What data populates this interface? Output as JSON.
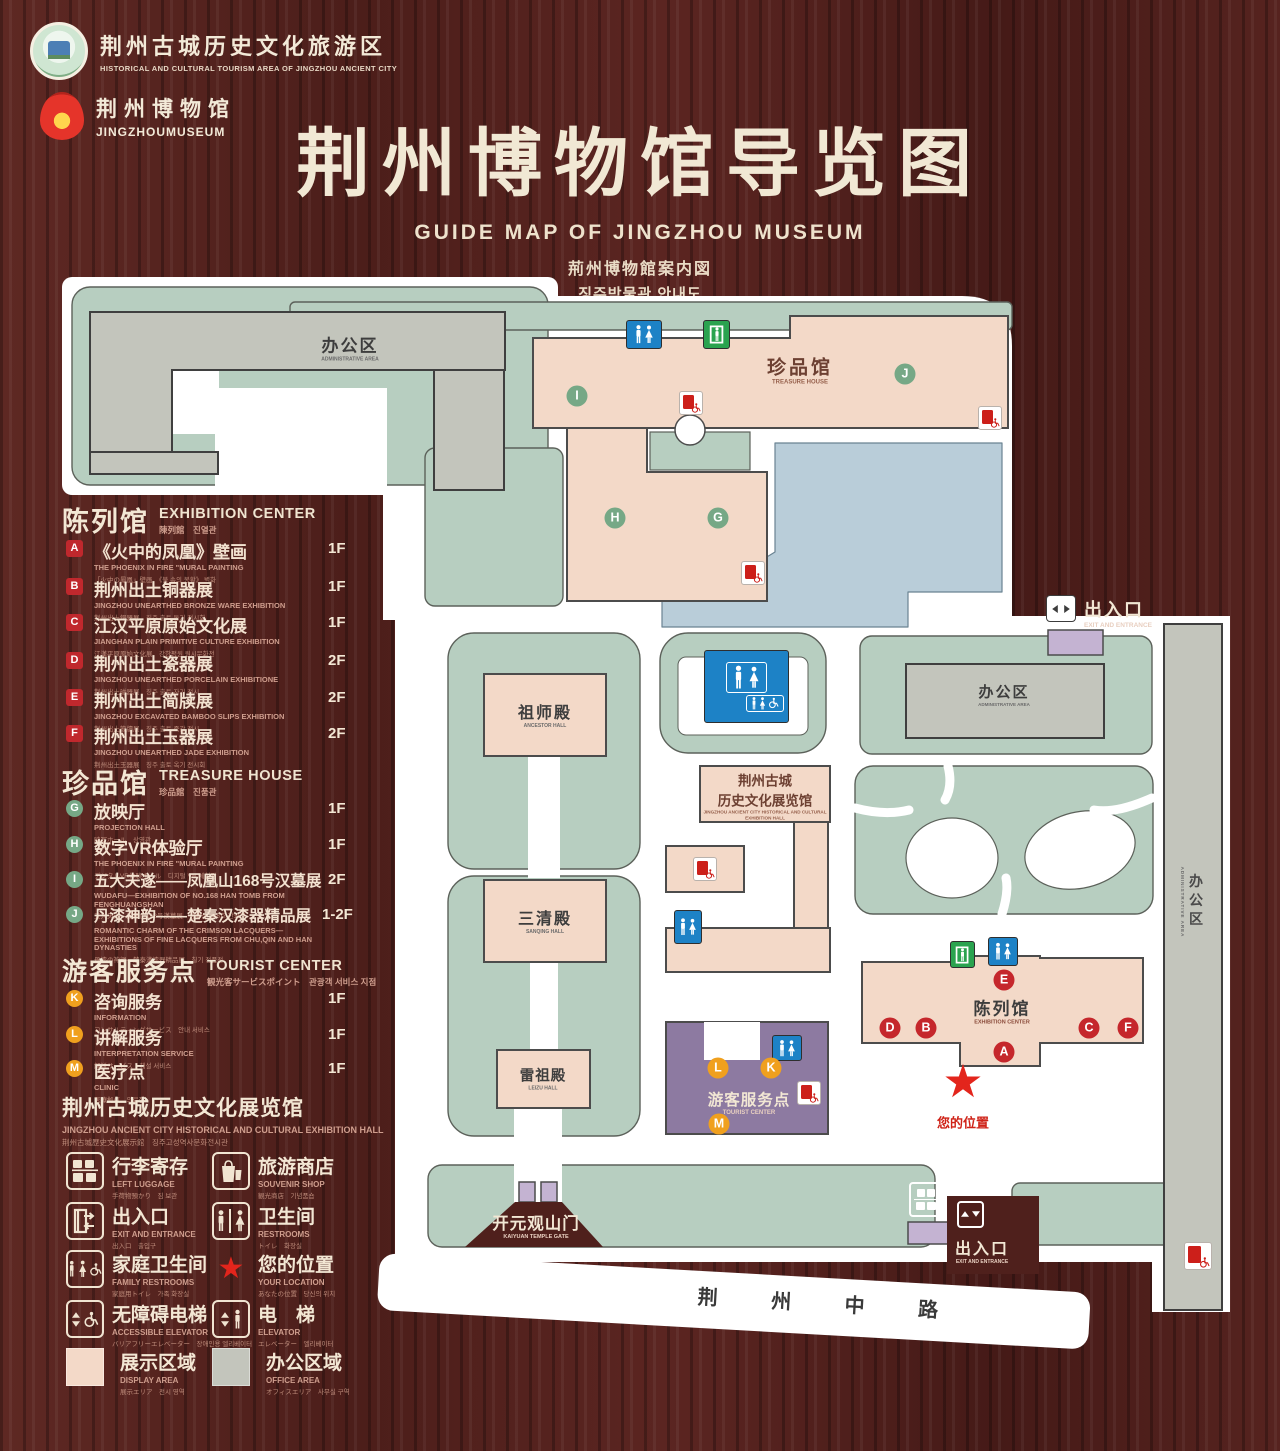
{
  "header": {
    "site_logo": {
      "zh": "荆州古城历史文化旅游区",
      "en": "HISTORICAL AND CULTURAL TOURISM AREA OF JINGZHOU ANCIENT CITY"
    },
    "museum_logo": {
      "zh": "荆州博物馆",
      "en": "JINGZHOUMUSEUM"
    },
    "title_zh": "荆州博物馆导览图",
    "title_en": "GUIDE MAP OF JINGZHOU MUSEUM",
    "title_ja": "荊州博物館案内図",
    "title_ko": "징주박물관 안내도"
  },
  "legend": {
    "sections": [
      {
        "title_zh": "陈列馆",
        "title_en": "EXHIBITION CENTER",
        "subtitle": "陳列館　진열관",
        "items": [
          {
            "letter": "A",
            "zh": "《火中的凤凰》壁画",
            "en": "THE PHOENIX IN FIRE \"MURAL PAINTING",
            "sub": "「火中の鳳凰」壁画　《불 속의 봉황》 벽화",
            "floor": "1F"
          },
          {
            "letter": "B",
            "zh": "荆州出土铜器展",
            "en": "JINGZHOU UNEARTHED BRONZE WARE EXHIBITION",
            "sub": "荆州出土銅器展　징주 출토 동기 전시회",
            "floor": "1F"
          },
          {
            "letter": "C",
            "zh": "江汉平原原始文化展",
            "en": "JIANGHAN PLAIN PRIMITIVE CULTURE EXHIBITION",
            "sub": "江漢平原原始文化展　강한평원 원시문화전",
            "floor": "1F"
          },
          {
            "letter": "D",
            "zh": "荆州出土瓷器展",
            "en": "JINGZHOU UNEARTHED PORCELAIN EXHIBITIONE",
            "sub": "荆州出土磁器展　징주 출토 자기 전시",
            "floor": "2F"
          },
          {
            "letter": "E",
            "zh": "荆州出土简牍展",
            "en": "JINGZHOU EXCAVATED BAMBOO SLIPS EXHIBITION",
            "sub": "荆州出土簡牘展　징주 출토 죽간 전시",
            "floor": "2F"
          },
          {
            "letter": "F",
            "zh": "荆州出土玉器展",
            "en": "JINGZHOU UNEARTHED JADE EXHIBITION",
            "sub": "荆州出土玉器展　징주 출토 옥기 전시회",
            "floor": "2F"
          }
        ]
      },
      {
        "title_zh": "珍品馆",
        "title_en": "TREASURE HOUSE",
        "subtitle": "珍品館　진품관",
        "items": [
          {
            "letter": "G",
            "zh": "放映厅",
            "en": "PROJECTION HALL",
            "sub": "映写ホール　상영관",
            "floor": "1F"
          },
          {
            "letter": "H",
            "zh": "数字VR体验厅",
            "en": "THE PHOENIX IN FIRE \"MURAL PAINTING",
            "sub": "デジタルVR体験ホール　디지털 VR 체험관",
            "floor": "1F"
          },
          {
            "letter": "I",
            "zh": "五大夫遂——凤凰山168号汉墓展",
            "en": "WUDAFU—EXHIBITION OF NO.168 HAN TOMB FROM FENGHUANGSHAN",
            "sub": "五大夫遂—鳳凰山168号漢墓展　봉황산 168호 한묘전",
            "floor": "2F"
          },
          {
            "letter": "J",
            "zh": "丹漆神韵——楚秦汉漆器精品展",
            "en": "ROMANTIC CHARM OF THE CRIMSON LACQUERS— EXHIBITIONS OF FINE LACQUERS FROM CHU,QIN AND HAN DYNASTIES",
            "sub": "丹漆の神韻—楚秦漢漆器精品展　칠기 정품전",
            "floor": "1-2F"
          }
        ]
      },
      {
        "title_zh": "游客服务点",
        "title_en": "TOURIST CENTER",
        "subtitle": "観光客サービスポイント　관광객 서비스 지점",
        "items": [
          {
            "letter": "K",
            "zh": "咨询服务",
            "en": "INFORMATION",
            "sub": "コンサルティングサービス　안내 서비스",
            "floor": "1F"
          },
          {
            "letter": "L",
            "zh": "讲解服务",
            "en": "INTERPRETATION SERVICE",
            "sub": "解説サービス　해설 서비스",
            "floor": "1F"
          },
          {
            "letter": "M",
            "zh": "医疗点",
            "en": "CLINIC",
            "sub": "医療拠点　의료점",
            "floor": "1F"
          }
        ]
      }
    ],
    "hall_note": {
      "zh": "荆州古城历史文化展览馆",
      "en": "JINGZHOU ANCIENT CITY HISTORICAL AND CULTURAL EXHIBITION HALL",
      "sub": "荆州古城歴史文化展示館　징주고성역사문화전시관"
    },
    "facilities": [
      {
        "icon": "left-luggage-icon",
        "zh": "行李寄存",
        "en": "LEFT LUGGAGE",
        "sub": "手荷物預かり　짐 보관"
      },
      {
        "icon": "souvenir-shop-icon",
        "zh": "旅游商店",
        "en": "SOUVENIR SHOP",
        "sub": "観光商店　기념품숍"
      },
      {
        "icon": "exit-entrance-icon",
        "zh": "出入口",
        "en": "EXIT AND ENTRANCE",
        "sub": "出入口　출입구"
      },
      {
        "icon": "restroom-icon",
        "zh": "卫生间",
        "en": "RESTROOMS",
        "sub": "トイレ　화장실"
      },
      {
        "icon": "family-restroom-icon",
        "zh": "家庭卫生间",
        "en": "FAMILY RESTROOMS",
        "sub": "家庭用トイレ　가족 화장실"
      },
      {
        "icon": "your-location-icon",
        "zh": "您的位置",
        "en": "YOUR LOCATION",
        "sub": "あなたの位置　당신의 위치"
      },
      {
        "icon": "accessible-elevator-icon",
        "zh": "无障碍电梯",
        "en": "ACCESSIBLE ELEVATOR",
        "sub": "バリアフリーエレベーター　장애인용 엘리베이터"
      },
      {
        "icon": "elevator-icon",
        "zh": "电　梯",
        "en": "ELEVATOR",
        "sub": "エレベーター　엘리베이터"
      },
      {
        "icon": "display-area-swatch",
        "zh": "展示区域",
        "en": "DISPLAY AREA",
        "sub": "展示エリア　전시 영역"
      },
      {
        "icon": "office-area-swatch",
        "zh": "办公区域",
        "en": "OFFICE AREA",
        "sub": "オフィスエリア　사무실 구역"
      }
    ]
  },
  "map": {
    "labels": {
      "admin_nw": {
        "zh": "办公区",
        "en": "ADMINISTRATIVE AREA"
      },
      "treasure": {
        "zh": "珍品馆",
        "en": "TREASURE HOUSE"
      },
      "ancestor": {
        "zh": "祖师殿",
        "en": "ANCESTOR HALL"
      },
      "sanqing": {
        "zh": "三清殿",
        "en": "SANQING HALL"
      },
      "leizu": {
        "zh": "雷祖殿",
        "en": "LEIZU HALL"
      },
      "exhibition_hall": {
        "zh1": "荆州古城",
        "zh2": "历史文化展览馆",
        "en": "JINGZHOU ANCIENT CITY HISTORICAL AND CULTURAL EXHIBITION HALL"
      },
      "admin_e": {
        "zh": "办公区",
        "en": "ADMINISTRATIVE AREA"
      },
      "admin_strip": {
        "zh": "办公区",
        "en": "ADMINISTRATIVE AREA"
      },
      "exhibition_center": {
        "zh": "陈列馆",
        "en": "EXHIBITION CENTER"
      },
      "tourist": {
        "zh": "游客服务点",
        "en": "TOURIST CENTER"
      },
      "your_location": {
        "zh": "您的位置"
      },
      "gate": {
        "zh": "开元观山门",
        "en": "KAIYUAN TEMPLE GATE"
      },
      "exit_e": {
        "zh": "出入口",
        "en": "EXIT AND ENTRANCE"
      },
      "exit_s": {
        "zh": "出入口",
        "en": "EXIT AND ENTRANCE"
      },
      "road": {
        "zh": "荆 州 中 路"
      }
    },
    "badges": {
      "A": "A",
      "B": "B",
      "C": "C",
      "D": "D",
      "E": "E",
      "F": "F",
      "G": "G",
      "H": "H",
      "I": "I",
      "J": "J",
      "K": "K",
      "L": "L",
      "M": "M"
    }
  },
  "colors": {
    "wood_background": "#552220",
    "cream_text": "#f2e7d4",
    "salmon_text": "#cf9e8e",
    "red_badge": "#c0282d",
    "green_badge": "#76a886",
    "orange_badge": "#f0a01e",
    "display_area": "#f3d9c8",
    "office_area": "#c3c5bc",
    "lawn": "#b7cec0",
    "lake": "#b9cdd9",
    "tourist_purple": "#8d7aa1",
    "lavender": "#c4b3d2",
    "restroom_blue": "#1d82c6",
    "exit_green": "#2aa34f",
    "marker_red": "#cc1f1a",
    "your_location_red": "#e3251c"
  }
}
